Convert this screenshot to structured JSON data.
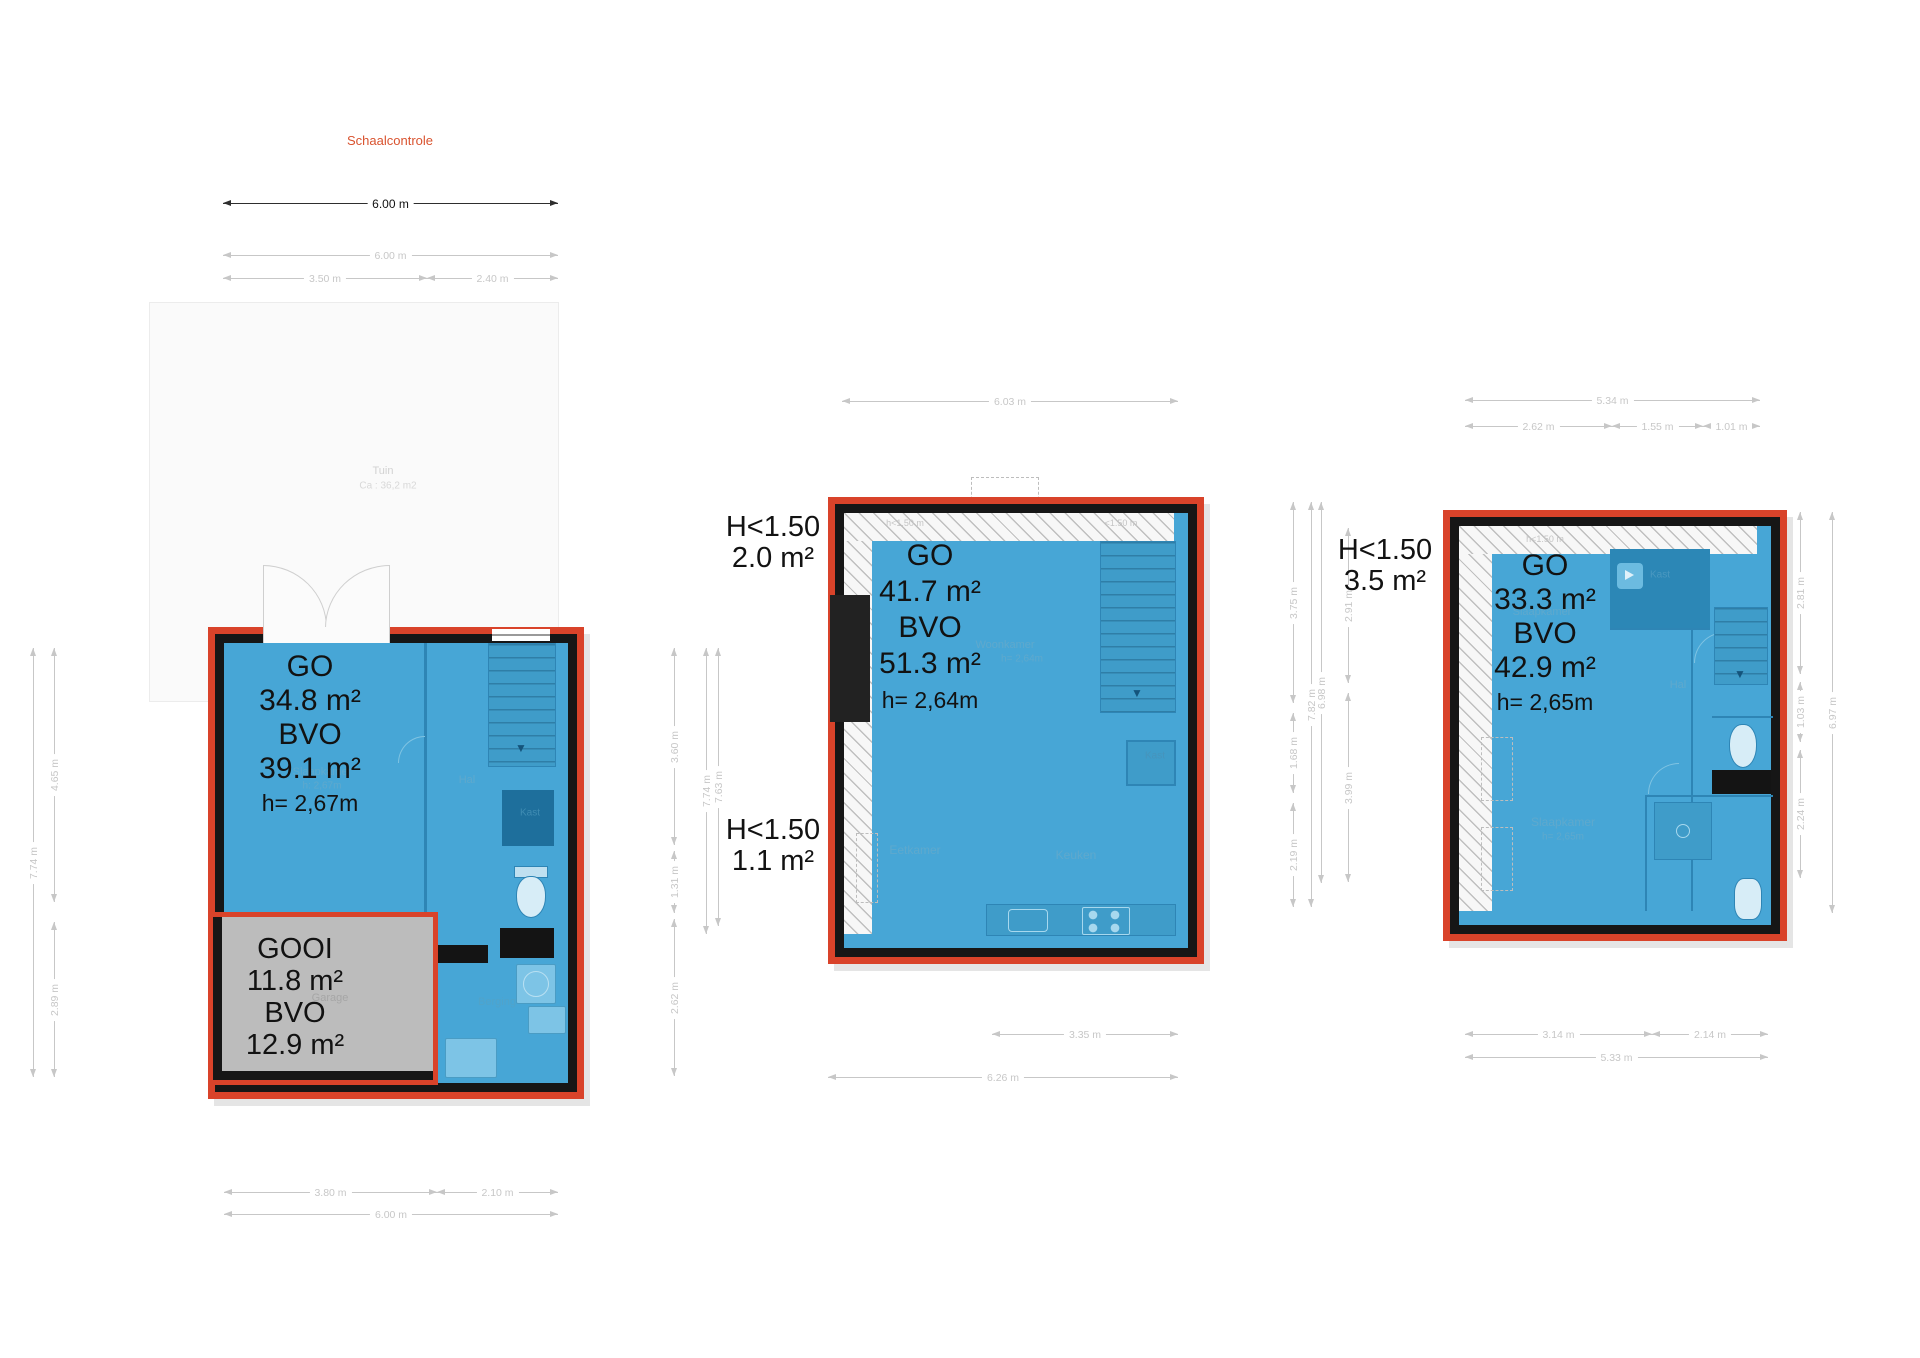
{
  "scale": {
    "title": "Schaalcontrole",
    "title_color": "#d9532f",
    "bar_label": "6.00 m"
  },
  "colors": {
    "accent_red": "#d9432a",
    "floor_blue": "#47a6d6",
    "wall_black": "#161616",
    "dim_gray": "#c7c7c7",
    "gooi_gray": "#bcbcbc"
  },
  "dims": [
    {
      "label": "6.00 m",
      "o": "h",
      "x": 223,
      "y": 203,
      "len": 335,
      "dark": true
    },
    {
      "label": "6.00 m",
      "o": "h",
      "x": 223,
      "y": 255,
      "len": 335
    },
    {
      "label": "3.50 m",
      "o": "h",
      "x": 223,
      "y": 278,
      "len": 204
    },
    {
      "label": "2.40 m",
      "o": "h",
      "x": 427,
      "y": 278,
      "len": 131
    },
    {
      "label": "3.80 m",
      "o": "h",
      "x": 224,
      "y": 1192,
      "len": 213
    },
    {
      "label": "2.10 m",
      "o": "h",
      "x": 437,
      "y": 1192,
      "len": 121
    },
    {
      "label": "6.00 m",
      "o": "h",
      "x": 224,
      "y": 1214,
      "len": 334
    },
    {
      "label": "7.74 m",
      "o": "v",
      "x": 33,
      "y": 648,
      "len": 429
    },
    {
      "label": "4.65 m",
      "o": "v",
      "x": 54,
      "y": 648,
      "len": 254
    },
    {
      "label": "2.89 m",
      "o": "v",
      "x": 54,
      "y": 922,
      "len": 155
    },
    {
      "label": "6.03 m",
      "o": "h",
      "x": 842,
      "y": 401,
      "len": 336
    },
    {
      "label": "3.35 m",
      "o": "h",
      "x": 992,
      "y": 1034,
      "len": 186
    },
    {
      "label": "6.26 m",
      "o": "h",
      "x": 828,
      "y": 1077,
      "len": 350
    },
    {
      "label": "3.60 m",
      "o": "v",
      "x": 674,
      "y": 648,
      "len": 197
    },
    {
      "label": "1.31 m",
      "o": "v",
      "x": 674,
      "y": 851,
      "len": 62
    },
    {
      "label": "2.62 m",
      "o": "v",
      "x": 674,
      "y": 919,
      "len": 157
    },
    {
      "label": "7.74 m",
      "o": "v",
      "x": 706,
      "y": 648,
      "len": 286
    },
    {
      "label": "7.63 m",
      "o": "v",
      "x": 718,
      "y": 648,
      "len": 278
    },
    {
      "label": "5.34 m",
      "o": "h",
      "x": 1465,
      "y": 400,
      "len": 295
    },
    {
      "label": "2.62 m",
      "o": "h",
      "x": 1465,
      "y": 426,
      "len": 147
    },
    {
      "label": "1.55 m",
      "o": "h",
      "x": 1612,
      "y": 426,
      "len": 91
    },
    {
      "label": "1.01 m",
      "o": "h",
      "x": 1703,
      "y": 426,
      "len": 57
    },
    {
      "label": "3.14 m",
      "o": "h",
      "x": 1465,
      "y": 1034,
      "len": 187
    },
    {
      "label": "2.14 m",
      "o": "h",
      "x": 1652,
      "y": 1034,
      "len": 116
    },
    {
      "label": "5.33 m",
      "o": "h",
      "x": 1465,
      "y": 1057,
      "len": 303
    },
    {
      "label": "3.75 m",
      "o": "v",
      "x": 1293,
      "y": 502,
      "len": 201
    },
    {
      "label": "1.68 m",
      "o": "v",
      "x": 1293,
      "y": 713,
      "len": 80
    },
    {
      "label": "2.19 m",
      "o": "v",
      "x": 1293,
      "y": 803,
      "len": 104
    },
    {
      "label": "7.82 m",
      "o": "v",
      "x": 1311,
      "y": 502,
      "len": 405
    },
    {
      "label": "6.98 m",
      "o": "v",
      "x": 1321,
      "y": 502,
      "len": 381
    },
    {
      "label": "2.91 m",
      "o": "v",
      "x": 1348,
      "y": 528,
      "len": 155
    },
    {
      "label": "3.99 m",
      "o": "v",
      "x": 1348,
      "y": 693,
      "len": 189
    },
    {
      "label": "2.81 m",
      "o": "v",
      "x": 1800,
      "y": 512,
      "len": 162
    },
    {
      "label": "1.03 m",
      "o": "v",
      "x": 1800,
      "y": 682,
      "len": 60
    },
    {
      "label": "2.24 m",
      "o": "v",
      "x": 1800,
      "y": 750,
      "len": 128
    },
    {
      "label": "6.97 m",
      "o": "v",
      "x": 1832,
      "y": 512,
      "len": 401
    }
  ],
  "room_labels": [
    {
      "t": "Tuin",
      "x": 383,
      "y": 471,
      "c": "#d2d2d2",
      "s": 11
    },
    {
      "t": "Ca : 36,2 m2",
      "x": 388,
      "y": 486,
      "c": "#d8d8d8",
      "s": 10
    },
    {
      "t": "Slaapkamer",
      "x": 322,
      "y": 772,
      "c": "#5fa9cd",
      "s": 11
    },
    {
      "t": "h: 2,67m",
      "x": 322,
      "y": 786,
      "c": "#5fa9cd",
      "s": 10
    },
    {
      "t": "Hal",
      "x": 467,
      "y": 780,
      "c": "#5fa9cd",
      "s": 11
    },
    {
      "t": "Kast",
      "x": 530,
      "y": 813,
      "c": "#3f8cb3",
      "s": 10
    },
    {
      "t": "Garage",
      "x": 330,
      "y": 998,
      "c": "#a6a6a6",
      "s": 11
    },
    {
      "t": "Berging",
      "x": 497,
      "y": 1002,
      "c": "#51a3c9",
      "s": 11
    },
    {
      "t": "h<1.50 m",
      "x": 905,
      "y": 523,
      "c": "#c4c4c4",
      "s": 9
    },
    {
      "t": "<1.50 m",
      "x": 1121,
      "y": 523,
      "c": "#c4c4c4",
      "s": 9
    },
    {
      "t": "Woonkamer",
      "x": 1005,
      "y": 645,
      "c": "#5fa9cd",
      "s": 11
    },
    {
      "t": "h= 2,64m",
      "x": 1022,
      "y": 659,
      "c": "#5fa9cd",
      "s": 10
    },
    {
      "t": "Eetkamer",
      "x": 915,
      "y": 850,
      "c": "#5fa9cd",
      "s": 12
    },
    {
      "t": "Keuken",
      "x": 1076,
      "y": 855,
      "c": "#5fa9cd",
      "s": 12
    },
    {
      "t": "Kast",
      "x": 1155,
      "y": 756,
      "c": "#4694bc",
      "s": 10
    },
    {
      "t": "h<1.50 m",
      "x": 1545,
      "y": 539,
      "c": "#c4c4c4",
      "s": 9
    },
    {
      "t": "Kast",
      "x": 1660,
      "y": 575,
      "c": "#4a98c0",
      "s": 10
    },
    {
      "t": "Slaapkamer",
      "x": 1542,
      "y": 612,
      "c": "#5fa9cd",
      "s": 11
    },
    {
      "t": "Hal",
      "x": 1678,
      "y": 685,
      "c": "#5fa9cd",
      "s": 11
    },
    {
      "t": "Slaapkamer",
      "x": 1563,
      "y": 822,
      "c": "#5fa9cd",
      "s": 12
    },
    {
      "t": "h= 2,65m",
      "x": 1563,
      "y": 837,
      "c": "#5fa9cd",
      "s": 10
    }
  ],
  "area_blocks": [
    {
      "x": 310,
      "y": 650,
      "lh": 34,
      "lines": [
        [
          "GO",
          30
        ],
        [
          "34.8 m²",
          30
        ],
        [
          "BVO",
          30
        ],
        [
          "39.1 m²",
          30
        ],
        [
          "h= 2,67m",
          23
        ]
      ]
    },
    {
      "x": 295,
      "y": 933,
      "lh": 32,
      "lines": [
        [
          "GOOI",
          29
        ],
        [
          "11.8 m²",
          29
        ],
        [
          "BVO",
          29
        ],
        [
          "12.9 m²",
          29
        ]
      ]
    },
    {
      "x": 930,
      "y": 538,
      "lh": 36,
      "lines": [
        [
          "GO",
          30
        ],
        [
          "41.7 m²",
          30
        ],
        [
          "BVO",
          30
        ],
        [
          "51.3 m²",
          30
        ],
        [
          "h= 2,64m",
          23
        ]
      ]
    },
    {
      "x": 773,
      "y": 512,
      "lh": 31,
      "lines": [
        [
          "H<1.50",
          29
        ],
        [
          "2.0 m²",
          29
        ]
      ]
    },
    {
      "x": 773,
      "y": 815,
      "lh": 31,
      "lines": [
        [
          "H<1.50",
          29
        ],
        [
          "1.1 m²",
          29
        ]
      ]
    },
    {
      "x": 1545,
      "y": 549,
      "lh": 34,
      "lines": [
        [
          "GO",
          30
        ],
        [
          "33.3 m²",
          30
        ],
        [
          "BVO",
          30
        ],
        [
          "42.9 m²",
          30
        ],
        [
          "h= 2,65m",
          23
        ]
      ]
    },
    {
      "x": 1385,
      "y": 535,
      "lh": 31,
      "lines": [
        [
          "H<1.50",
          29
        ],
        [
          "3.5 m²",
          29
        ]
      ]
    }
  ]
}
